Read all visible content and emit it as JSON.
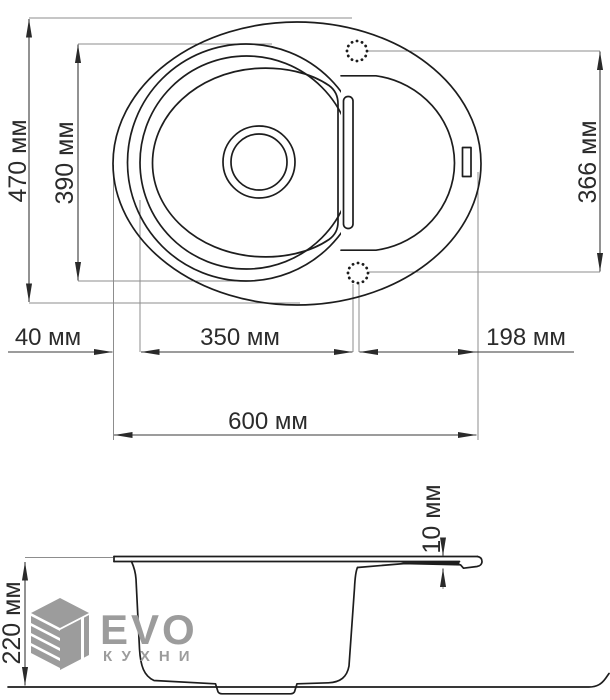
{
  "colors": {
    "line": "#1d1d1d",
    "dim": "#3a3a3a",
    "extension": "#8d8d8d",
    "logo": "#9c9c9c"
  },
  "dimensions": {
    "overall_depth": "470 мм",
    "bowl_depth": "390 мм",
    "right_depth": "366 мм",
    "left_offset": "40 мм",
    "bowl_width": "350 мм",
    "drainer_width": "198 мм",
    "overall_width": "600 мм",
    "side_height": "220 мм",
    "rim_thickness": "10 мм"
  },
  "logo": {
    "brand": "EVO",
    "subtitle": "КУХНИ"
  }
}
